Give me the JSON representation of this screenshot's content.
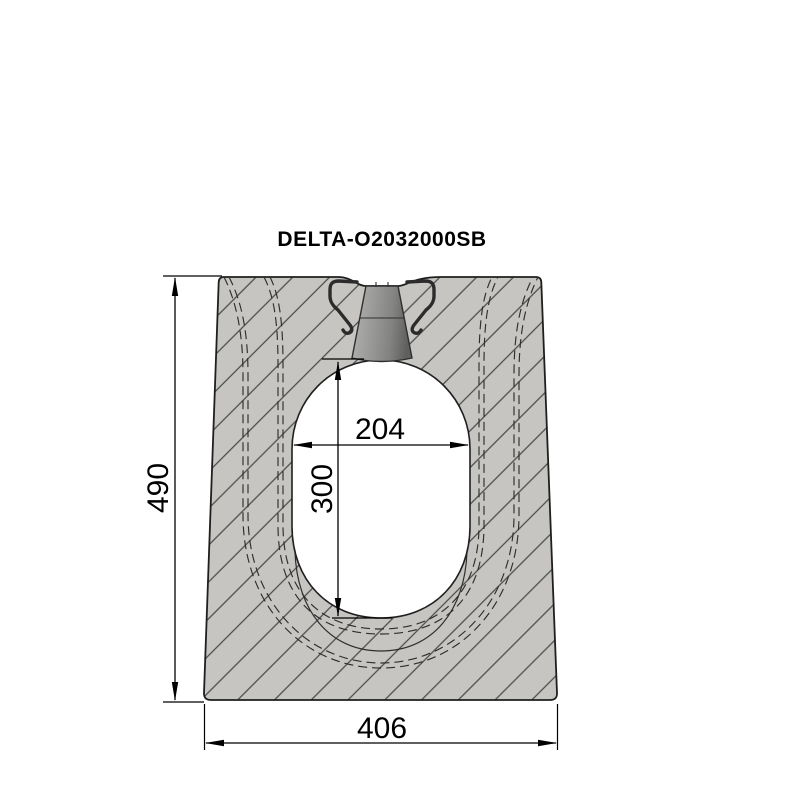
{
  "title": "DELTA-O2032000SB",
  "dims": {
    "overall_height": "490",
    "bottom_width": "406",
    "opening_width": "204",
    "opening_height": "300"
  },
  "drawing": {
    "kind": "technical cross-section of slotted concrete drainage channel",
    "hatch_style": "45-degree diagonal section hatching",
    "parts": [
      "concrete-channel-body",
      "egg-shaped-channel-opening",
      "slot-inlet-funnel",
      "fixing-clip-left",
      "fixing-clip-right",
      "socket-hidden-contours"
    ]
  },
  "colors": {
    "background": "#ffffff",
    "concrete_fill": "#c6c5c2",
    "hatch_line": "#4a4a48",
    "outline": "#1f1f1f",
    "dimension": "#000000",
    "funnel_light": "#b3b3b1",
    "funnel_dark": "#5f5f5d",
    "clip": "#2b2b2b",
    "opening_fill": "#ffffff"
  }
}
